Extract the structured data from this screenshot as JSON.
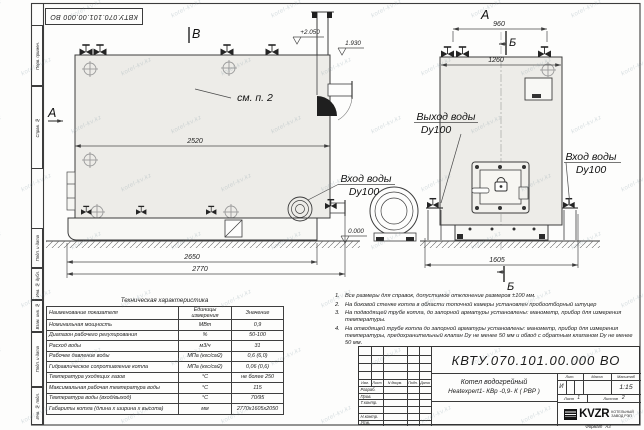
{
  "sheet": {
    "margin_top": [
      "Перв. примен.",
      "Справ. №"
    ],
    "margin_bottom": [
      "Подп. и дата",
      "Инв. № дубл.",
      "Взам. инв. №",
      "Подп. и дата",
      "Инв. № подл."
    ],
    "format_label": "Формат",
    "format_value": "А3"
  },
  "watermark": {
    "text": "kotel-kv.kz"
  },
  "views": {
    "marker_v": "В",
    "marker_a_side": "А",
    "marker_a_front": "А",
    "marker_b_top": "Б",
    "marker_b_bottom": "Б",
    "see_note": "см. п. 2",
    "elev_top": "+2.050",
    "elev_stub": "1.930",
    "elev_zero": "0.000",
    "outlet_title": "Выход воды",
    "outlet_dn": "Dy100",
    "inlet_side_title": "Вход воды",
    "inlet_side_dn": "Dy100",
    "inlet_front_title": "Вход воды",
    "inlet_front_dn": "Dy100",
    "dim_2520": "2520",
    "dim_2650": "2650",
    "dim_2770": "2770",
    "dim_960": "960",
    "dim_1260": "1260",
    "dim_1605": "1605"
  },
  "spec_table": {
    "title": "Техническая характеристика",
    "col_name": "Наименование показателя",
    "col_units_1": "Единицы",
    "col_units_2": "измерения",
    "col_value": "Значение",
    "rows": [
      [
        "Номинальная мощность",
        "МВт",
        "0,9"
      ],
      [
        "Диапазон рабочего регулирования",
        "%",
        "50-100"
      ],
      [
        "Расход воды",
        "м3/ч",
        "31"
      ],
      [
        "Рабочее давление воды",
        "МПа (кгс/см2)",
        "0,6 (6,0)"
      ],
      [
        "Гидравлическое сопротивление котла",
        "МПа (кгс/см2)",
        "0,06 (0,6)"
      ],
      [
        "Температура уходящих газов",
        "°С",
        "не более 250"
      ],
      [
        "Максимальная рабочая температура воды",
        "°С",
        "115"
      ],
      [
        "Температура воды (вход/выход)",
        "°С",
        "70/95"
      ],
      [
        "Габариты котла (длина х ширина х высота)",
        "мм",
        "2770х1605х2050"
      ]
    ]
  },
  "notes": {
    "items": [
      {
        "n": "1.",
        "t": "Все размеры для справок, допустимое отклонение размеров ±100 мм."
      },
      {
        "n": "2.",
        "t": "На боковой стенке котла в области топочной камеры установлен пробоотборный штуцер"
      },
      {
        "n": "3.",
        "t": "На подводящей трубе котла, до запорной арматуры установлены: манометр, прибор для измерения температуры."
      },
      {
        "n": "4.",
        "t": "На отводящей трубе котла до запорной арматуры установлены: манометр, прибор для измерения температуры, предохранительный клапан Dу не менее 50 мм и обвод с обратным клапаном Dу не менее 50 мм."
      }
    ]
  },
  "title_block": {
    "designation": "КВТУ.070.101.00.000  ВО",
    "name_line1": "Котел водогрейный",
    "name_line2": "Heatexpert1- КВр -0,9- К ( РВР )",
    "col_izm": "Изм.",
    "col_list": "Лист",
    "col_doc": "N докум.",
    "col_sign": "Подп.",
    "col_date": "Дата",
    "row_labels": [
      "Разраб.",
      "Пров.",
      "Т.контр.",
      "",
      "Н.контр.",
      "Утв."
    ],
    "lit_label": "Лит.",
    "mass_label": "Масса",
    "scale_label": "Масштаб",
    "lit_value": "И",
    "scale_value": "1:15",
    "sheet_label": "Лист",
    "sheet_value": "1",
    "sheets_label": "Листов",
    "sheets_value": "2",
    "logo_text": "KVZR",
    "company_line1": "КОТЕЛЬНЫЙ",
    "company_line2": "ЗАВОД РЭП"
  }
}
